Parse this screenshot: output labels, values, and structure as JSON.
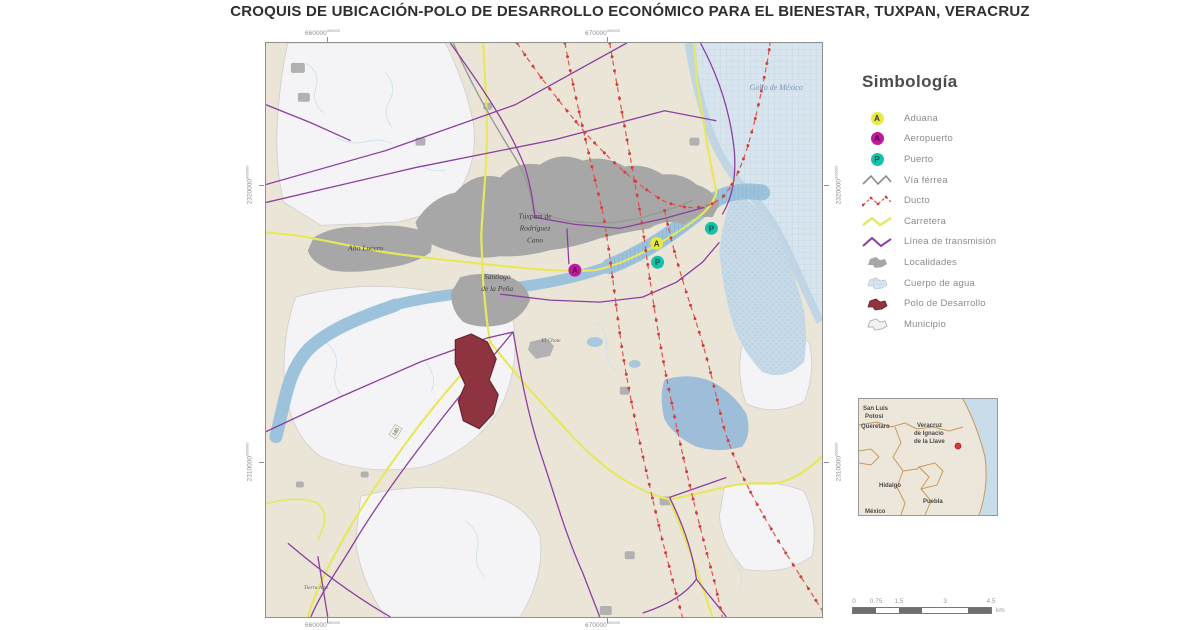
{
  "title": "CROQUIS DE UBICACIÓN-POLO DE DESARROLLO ECONÓMICO PARA EL BIENESTAR, TUXPAN, VERACRUZ",
  "map": {
    "sea_label": "Golfo de México",
    "labels": {
      "tuxpam": [
        "Túxpam de",
        "Rodríguez",
        "Cano"
      ],
      "alto_lucero": "Alto Lucero",
      "santiago": [
        "Santiago",
        "de la Peña"
      ],
      "locality_1": "El Chote",
      "locality_2": "Tierra Alta",
      "road_shield": "180"
    },
    "markers": {
      "aduana": "A",
      "aeropuerto": "A",
      "puerto": "P"
    },
    "coords": {
      "top": [
        {
          "main": "660000",
          "sup": "000000"
        },
        {
          "main": "670000",
          "sup": "000000"
        }
      ],
      "bottom": [
        {
          "main": "660000",
          "sup": "000000"
        },
        {
          "main": "670000",
          "sup": "000000"
        }
      ],
      "left": [
        {
          "main": "2320000",
          "sup": "000000"
        },
        {
          "main": "2310000",
          "sup": "000000"
        }
      ],
      "right": [
        {
          "main": "2320000",
          "sup": "000000"
        },
        {
          "main": "2310000",
          "sup": "000000"
        }
      ]
    }
  },
  "legend": {
    "title": "Simbología",
    "items": [
      {
        "label": "Aduana",
        "letter": "A",
        "color": "#e7e93f"
      },
      {
        "label": "Aeropuerto",
        "letter": "A",
        "color": "#c0189c"
      },
      {
        "label": "Puerto",
        "letter": "P",
        "color": "#14c2aa"
      },
      {
        "label": "Vía férrea",
        "color": "#8a8a8a"
      },
      {
        "label": "Ducto",
        "color": "#e0544d"
      },
      {
        "label": "Carretera",
        "color": "#e7e75f"
      },
      {
        "label": "Línea de transmisión",
        "color": "#8b3fa0"
      },
      {
        "label": "Localidades",
        "color": "#a7a7a7"
      },
      {
        "label": "Cuerpo de agua",
        "color": "#c9dcea"
      },
      {
        "label": "Polo de Desarrollo",
        "color": "#8e3340"
      },
      {
        "label": "Municipio",
        "color": "#f2f2f2"
      }
    ]
  },
  "inset": {
    "labels": {
      "san_luis": [
        "San Luis",
        "Potosí"
      ],
      "queretaro": "Querétaro",
      "veracruz": [
        "Veracruz",
        "de Ignacio",
        "de la Llave"
      ],
      "hidalgo": "Hidalgo",
      "puebla": "Puebla",
      "mexico": "México"
    }
  },
  "scalebar": {
    "ticks": [
      "0",
      "0.75",
      "1.5",
      "3",
      "4.5"
    ],
    "unit": "km"
  }
}
